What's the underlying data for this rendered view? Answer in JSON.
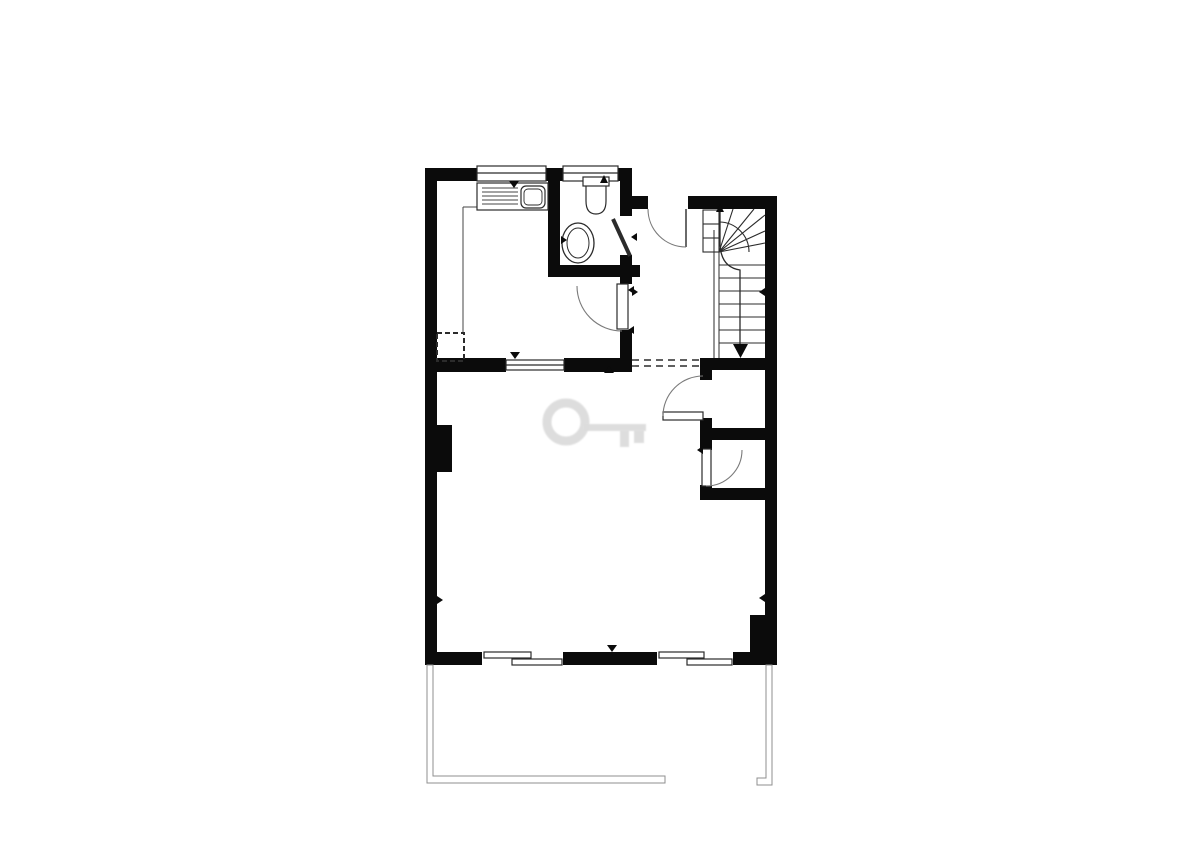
{
  "meta": {
    "document_type": "architectural floor plan",
    "style": "black and white line drawing",
    "canvas": {
      "w": 1200,
      "h": 849
    }
  },
  "colors": {
    "bg": "#ffffff",
    "wall": "#0b0b0b",
    "line": "#2b2b2b",
    "thin": "#444444",
    "swing": "#7a7a7a",
    "terrace": "#8f8f8f",
    "watermark": "#dcdcdc"
  },
  "floorplan": {
    "shapes": [
      {
        "t": "e",
        "n": "watermark-key-bow",
        "cx": 566,
        "cy": 422,
        "rx": 19,
        "ry": 19,
        "sw": 9,
        "c": "#dcdcdc",
        "cls": "wm"
      },
      {
        "t": "r",
        "n": "watermark-key-shaft",
        "x": 584,
        "y": 424,
        "w": 62,
        "h": 7,
        "f": "#dcdcdc",
        "cls": "wm"
      },
      {
        "t": "r",
        "n": "watermark-key-tooth-1",
        "x": 620,
        "y": 430,
        "w": 9,
        "h": 17,
        "f": "#dcdcdc",
        "cls": "wm"
      },
      {
        "t": "r",
        "n": "watermark-key-tooth-2",
        "x": 634,
        "y": 430,
        "w": 10,
        "h": 13,
        "f": "#dcdcdc",
        "cls": "wm"
      },
      {
        "t": "r",
        "n": "wall-left",
        "x": 425,
        "y": 168,
        "w": 12,
        "h": 497
      },
      {
        "t": "r",
        "n": "wall-top-kitchen",
        "x": 425,
        "y": 168,
        "w": 52,
        "h": 13
      },
      {
        "t": "r",
        "n": "wall-top-between-windows",
        "x": 546,
        "y": 168,
        "w": 17,
        "h": 13
      },
      {
        "t": "r",
        "n": "wall-top-right-of-bath",
        "x": 618,
        "y": 168,
        "w": 14,
        "h": 13
      },
      {
        "t": "r",
        "n": "wall-bathroom-left",
        "x": 548,
        "y": 168,
        "w": 12,
        "h": 109
      },
      {
        "t": "r",
        "n": "wall-bathroom-bottom",
        "x": 548,
        "y": 265,
        "w": 92,
        "h": 12
      },
      {
        "t": "r",
        "n": "wall-bathroom-right-top",
        "x": 620,
        "y": 180,
        "w": 12,
        "h": 36
      },
      {
        "t": "r",
        "n": "wall-bathroom-right-bottom",
        "x": 620,
        "y": 255,
        "w": 12,
        "h": 22
      },
      {
        "t": "r",
        "n": "wall-hall-top-left",
        "x": 632,
        "y": 196,
        "w": 16,
        "h": 13
      },
      {
        "t": "r",
        "n": "wall-hall-top-right",
        "x": 688,
        "y": 196,
        "w": 77,
        "h": 13
      },
      {
        "t": "r",
        "n": "wall-kitchen-hall-upper",
        "x": 620,
        "y": 277,
        "w": 12,
        "h": 7
      },
      {
        "t": "r",
        "n": "wall-kitchen-hall-lower",
        "x": 620,
        "y": 330,
        "w": 12,
        "h": 42
      },
      {
        "t": "r",
        "n": "wall-kitchen-bottom-left",
        "x": 425,
        "y": 358,
        "w": 78,
        "h": 14
      },
      {
        "t": "r",
        "n": "wall-kitchen-bottom-right",
        "x": 567,
        "y": 358,
        "w": 65,
        "h": 14
      },
      {
        "t": "r",
        "n": "wall-closet-top",
        "x": 700,
        "y": 358,
        "w": 77,
        "h": 12
      },
      {
        "t": "r",
        "n": "wall-closet1-left-upper",
        "x": 700,
        "y": 366,
        "w": 12,
        "h": 14
      },
      {
        "t": "r",
        "n": "wall-closet1-left-lower",
        "x": 700,
        "y": 418,
        "w": 12,
        "h": 22
      },
      {
        "t": "r",
        "n": "wall-closet-mid",
        "x": 700,
        "y": 428,
        "w": 77,
        "h": 12
      },
      {
        "t": "r",
        "n": "wall-closet2-left-upper",
        "x": 700,
        "y": 440,
        "w": 12,
        "h": 10
      },
      {
        "t": "r",
        "n": "wall-closet2-left-lower",
        "x": 700,
        "y": 485,
        "w": 12,
        "h": 15
      },
      {
        "t": "r",
        "n": "wall-closet-bottom",
        "x": 700,
        "y": 488,
        "w": 77,
        "h": 12
      },
      {
        "t": "r",
        "n": "wall-right",
        "x": 765,
        "y": 196,
        "w": 12,
        "h": 469
      },
      {
        "t": "r",
        "n": "wall-bottom-left",
        "x": 425,
        "y": 652,
        "w": 57,
        "h": 13
      },
      {
        "t": "r",
        "n": "wall-bottom-middle",
        "x": 563,
        "y": 652,
        "w": 94,
        "h": 13
      },
      {
        "t": "r",
        "n": "wall-bottom-right",
        "x": 733,
        "y": 652,
        "w": 44,
        "h": 13
      },
      {
        "t": "r",
        "n": "wall-bottom-right-step",
        "x": 750,
        "y": 615,
        "w": 27,
        "h": 40
      },
      {
        "t": "r",
        "n": "chimney-pillar",
        "x": 437,
        "y": 425,
        "w": 15,
        "h": 47
      },
      {
        "t": "r",
        "n": "sliding-door-left-bg",
        "x": 482,
        "y": 652,
        "w": 81,
        "h": 13,
        "f": "#ffffff"
      },
      {
        "t": "o",
        "n": "sliding-door-left-panel-outer",
        "x": 484,
        "y": 652,
        "w": 47,
        "h": 6
      },
      {
        "t": "o",
        "n": "sliding-door-left-panel-inner",
        "x": 512,
        "y": 659,
        "w": 50,
        "h": 6
      },
      {
        "t": "r",
        "n": "sliding-door-right-bg",
        "x": 657,
        "y": 652,
        "w": 76,
        "h": 13,
        "f": "#ffffff"
      },
      {
        "t": "o",
        "n": "sliding-door-right-panel-outer",
        "x": 659,
        "y": 652,
        "w": 45,
        "h": 6
      },
      {
        "t": "o",
        "n": "sliding-door-right-panel-inner",
        "x": 687,
        "y": 659,
        "w": 45,
        "h": 6
      },
      {
        "t": "o",
        "n": "kitchen-window",
        "x": 477,
        "y": 166,
        "w": 69,
        "h": 15
      },
      {
        "t": "l",
        "n": "kitchen-window-midline",
        "x1": 477,
        "y1": 173,
        "x2": 546,
        "y2": 173
      },
      {
        "t": "o",
        "n": "bathroom-window",
        "x": 563,
        "y": 166,
        "w": 55,
        "h": 15
      },
      {
        "t": "l",
        "n": "bathroom-window-midline",
        "x1": 563,
        "y1": 173,
        "x2": 618,
        "y2": 173
      },
      {
        "t": "r",
        "n": "serving-hatch-cap-left",
        "x": 500,
        "y": 358,
        "w": 6,
        "h": 14
      },
      {
        "t": "r",
        "n": "serving-hatch-cap-right",
        "x": 564,
        "y": 358,
        "w": 6,
        "h": 14
      },
      {
        "t": "o",
        "n": "serving-hatch-window",
        "x": 506,
        "y": 360,
        "w": 58,
        "h": 10
      },
      {
        "t": "l",
        "n": "serving-hatch-midline",
        "x1": 506,
        "y1": 365,
        "x2": 564,
        "y2": 365
      },
      {
        "t": "l",
        "n": "kitchen-counter-edge-h",
        "x1": 463,
        "y1": 207,
        "x2": 477,
        "y2": 207,
        "c": "#444444",
        "sw": 1
      },
      {
        "t": "l",
        "n": "kitchen-counter-edge-v",
        "x1": 463,
        "y1": 207,
        "x2": 463,
        "y2": 333,
        "c": "#444444",
        "sw": 1
      },
      {
        "t": "o",
        "n": "kitchen-sink-unit",
        "x": 477,
        "y": 183,
        "w": 71,
        "h": 27
      },
      {
        "t": "l",
        "n": "kitchen-sink-drainer-1",
        "x1": 482,
        "y1": 188,
        "x2": 518,
        "y2": 188,
        "c": "#444444",
        "sw": 0.9
      },
      {
        "t": "l",
        "n": "kitchen-sink-drainer-2",
        "x1": 482,
        "y1": 192,
        "x2": 518,
        "y2": 192,
        "c": "#444444",
        "sw": 0.9
      },
      {
        "t": "l",
        "n": "kitchen-sink-drainer-3",
        "x1": 482,
        "y1": 196,
        "x2": 518,
        "y2": 196,
        "c": "#444444",
        "sw": 0.9
      },
      {
        "t": "l",
        "n": "kitchen-sink-drainer-4",
        "x1": 482,
        "y1": 200,
        "x2": 518,
        "y2": 200,
        "c": "#444444",
        "sw": 0.9
      },
      {
        "t": "l",
        "n": "kitchen-sink-drainer-5",
        "x1": 482,
        "y1": 204,
        "x2": 518,
        "y2": 204,
        "c": "#444444",
        "sw": 0.9
      },
      {
        "t": "o",
        "n": "kitchen-sink-bowl",
        "x": 521,
        "y": 186,
        "w": 24,
        "h": 22,
        "rx": 5
      },
      {
        "t": "o",
        "n": "kitchen-sink-bowl-inner",
        "x": 524,
        "y": 189,
        "w": 18,
        "h": 16,
        "rx": 4,
        "sw": 0.9
      },
      {
        "t": "o",
        "n": "kitchen-storage-dashed-box",
        "x": 437,
        "y": 333,
        "w": 27,
        "h": 28,
        "sw": 2,
        "dash": "5,3",
        "f": "none"
      },
      {
        "t": "o",
        "n": "toilet-cistern",
        "x": 583,
        "y": 177,
        "w": 26,
        "h": 9
      },
      {
        "t": "p",
        "n": "toilet-bowl",
        "d": "M586,186 L586,201 Q586,214 596,214 Q606,214 606,201 L606,186",
        "sw": 1.2
      },
      {
        "t": "g",
        "n": "toilet-marker-arrow",
        "points": "600,183 608,183 604,175"
      },
      {
        "t": "e",
        "n": "wash-basin-outer",
        "cx": 578,
        "cy": 243,
        "rx": 16,
        "ry": 20,
        "sw": 1.3
      },
      {
        "t": "e",
        "n": "wash-basin-inner",
        "cx": 578,
        "cy": 243,
        "rx": 11,
        "ry": 15,
        "sw": 1
      },
      {
        "t": "g",
        "n": "basin-tap",
        "points": "561,236 561,244 567,240"
      },
      {
        "t": "l",
        "n": "entrance-door-leaf",
        "x1": 686,
        "y1": 209,
        "x2": 686,
        "y2": 247,
        "sw": 1.4
      },
      {
        "t": "p",
        "n": "entrance-door-swing",
        "d": "M648,209 A38,38 0 0 0 686,247",
        "c": "#7a7a7a",
        "sw": 1.1
      },
      {
        "t": "o",
        "n": "kitchen-door-leaf",
        "x": 617,
        "y": 284,
        "w": 11,
        "h": 45
      },
      {
        "t": "p",
        "n": "kitchen-door-swing",
        "d": "M577,286 A45,45 0 0 0 622,331",
        "c": "#7a7a7a",
        "sw": 1.1
      },
      {
        "t": "l",
        "n": "bathroom-door-leaf",
        "x1": 613,
        "y1": 219,
        "x2": 630,
        "y2": 256,
        "sw": 4
      },
      {
        "t": "g",
        "n": "bathroom-door-arrow",
        "points": "637,233 637,241 631,237"
      },
      {
        "t": "o",
        "n": "closet-door-1-leaf",
        "x": 663,
        "y": 412,
        "w": 40,
        "h": 8
      },
      {
        "t": "p",
        "n": "closet-door-1-swing",
        "d": "M663,416 A40,40 0 0 1 703,376",
        "c": "#7a7a7a",
        "sw": 1.1
      },
      {
        "t": "o",
        "n": "closet-door-2-leaf",
        "x": 702,
        "y": 449,
        "w": 9,
        "h": 37
      },
      {
        "t": "p",
        "n": "closet-door-2-swing",
        "d": "M742,450 A36,36 0 0 1 706,486",
        "c": "#7a7a7a",
        "sw": 1.1
      },
      {
        "t": "o",
        "n": "stair-upper-treads",
        "x": 703,
        "y": 210,
        "w": 16,
        "h": 42,
        "sw": 1.1
      },
      {
        "t": "l",
        "n": "stair-upper-tread-line-1",
        "x1": 703,
        "y1": 224,
        "x2": 719,
        "y2": 224,
        "sw": 1.1
      },
      {
        "t": "l",
        "n": "stair-upper-tread-line-2",
        "x1": 703,
        "y1": 238,
        "x2": 719,
        "y2": 238,
        "sw": 1.1
      },
      {
        "t": "l",
        "n": "stair-winder-line-1",
        "x1": 719,
        "y1": 252,
        "x2": 733,
        "y2": 209,
        "sw": 1.1
      },
      {
        "t": "l",
        "n": "stair-winder-line-2",
        "x1": 719,
        "y1": 252,
        "x2": 754,
        "y2": 209,
        "sw": 1.1
      },
      {
        "t": "l",
        "n": "stair-winder-line-3",
        "x1": 719,
        "y1": 252,
        "x2": 765,
        "y2": 215,
        "sw": 1.1
      },
      {
        "t": "l",
        "n": "stair-winder-line-4",
        "x1": 719,
        "y1": 252,
        "x2": 765,
        "y2": 231,
        "sw": 1.1
      },
      {
        "t": "l",
        "n": "stair-winder-line-5",
        "x1": 719,
        "y1": 252,
        "x2": 765,
        "y2": 243,
        "sw": 1.1
      },
      {
        "t": "p",
        "n": "stair-winder-arc",
        "d": "M719,222 A30,30 0 0 1 749,252",
        "sw": 1.1
      },
      {
        "t": "l",
        "n": "stair-tread-1",
        "x1": 719,
        "y1": 265,
        "x2": 765,
        "y2": 265,
        "sw": 1.1
      },
      {
        "t": "l",
        "n": "stair-tread-2",
        "x1": 719,
        "y1": 278,
        "x2": 765,
        "y2": 278,
        "sw": 1.1
      },
      {
        "t": "l",
        "n": "stair-tread-3",
        "x1": 719,
        "y1": 291,
        "x2": 765,
        "y2": 291,
        "sw": 1.1
      },
      {
        "t": "l",
        "n": "stair-tread-4",
        "x1": 719,
        "y1": 304,
        "x2": 765,
        "y2": 304,
        "sw": 1.1
      },
      {
        "t": "l",
        "n": "stair-tread-5",
        "x1": 719,
        "y1": 317,
        "x2": 765,
        "y2": 317,
        "sw": 1.1
      },
      {
        "t": "l",
        "n": "stair-tread-6",
        "x1": 719,
        "y1": 330,
        "x2": 765,
        "y2": 330,
        "sw": 1.1
      },
      {
        "t": "l",
        "n": "stair-tread-7",
        "x1": 719,
        "y1": 343,
        "x2": 765,
        "y2": 343,
        "sw": 1.1
      },
      {
        "t": "l",
        "n": "stair-stringer-outer",
        "x1": 714,
        "y1": 230,
        "x2": 714,
        "y2": 358,
        "sw": 1
      },
      {
        "t": "l",
        "n": "stair-stringer-inner",
        "x1": 719,
        "y1": 252,
        "x2": 719,
        "y2": 358,
        "sw": 1
      },
      {
        "t": "p",
        "n": "stair-direction-line",
        "d": "M720,212 L720,242 Q720,267 740,270 L740,344",
        "sw": 1.3
      },
      {
        "t": "g",
        "n": "stair-direction-arrow-up",
        "points": "716,212 724,212 720,204"
      },
      {
        "t": "g",
        "n": "stair-direction-arrow-down",
        "points": "733,344 748,344 740.5,358"
      },
      {
        "t": "l",
        "n": "hall-open-boundary-dash-1",
        "x1": 632,
        "y1": 360,
        "x2": 700,
        "y2": 360,
        "sw": 1.4,
        "dash": "7,5"
      },
      {
        "t": "l",
        "n": "hall-open-boundary-dash-2",
        "x1": 632,
        "y1": 366,
        "x2": 700,
        "y2": 366,
        "sw": 1.4,
        "dash": "7,5"
      },
      {
        "t": "g",
        "n": "wall-tick-left",
        "points": "437,596 437,604 443,600"
      },
      {
        "t": "g",
        "n": "wall-tick-right",
        "points": "765,594 765,602 759,598"
      },
      {
        "t": "g",
        "n": "hall-wall-tick",
        "points": "632,288 632,296 638,292"
      },
      {
        "t": "g",
        "n": "stair-wall-tick",
        "points": "765,288 765,296 759,292"
      },
      {
        "t": "g",
        "n": "kitchen-window-marker",
        "points": "509,181 519,181 514,188"
      },
      {
        "t": "g",
        "n": "serving-hatch-marker",
        "points": "510,352 520,352 515,359"
      },
      {
        "t": "g",
        "n": "bottom-wall-marker",
        "points": "607,645 617,645 612,652"
      },
      {
        "t": "g",
        "n": "living-room-marker",
        "points": "604,373 614,373 609,366"
      },
      {
        "t": "g",
        "n": "kitchen-door-tick-1",
        "points": "634,286 634,294 628,290"
      },
      {
        "t": "g",
        "n": "kitchen-door-tick-2",
        "points": "634,326 634,334 628,330"
      },
      {
        "t": "g",
        "n": "closet-door-2-tick",
        "points": "703,446 703,454 697,450"
      },
      {
        "t": "p",
        "n": "terrace-railing-left",
        "d": "M427,665 L427,783 L665,783 L665,776 L433,776 L433,665 Z",
        "c": "#8f8f8f",
        "sw": 1,
        "f": "#ffffff"
      },
      {
        "t": "p",
        "n": "terrace-railing-right",
        "d": "M766,665 L766,778 L757,778 L757,785 L772,785 L772,665 Z",
        "c": "#8f8f8f",
        "sw": 1,
        "f": "#ffffff"
      }
    ]
  }
}
